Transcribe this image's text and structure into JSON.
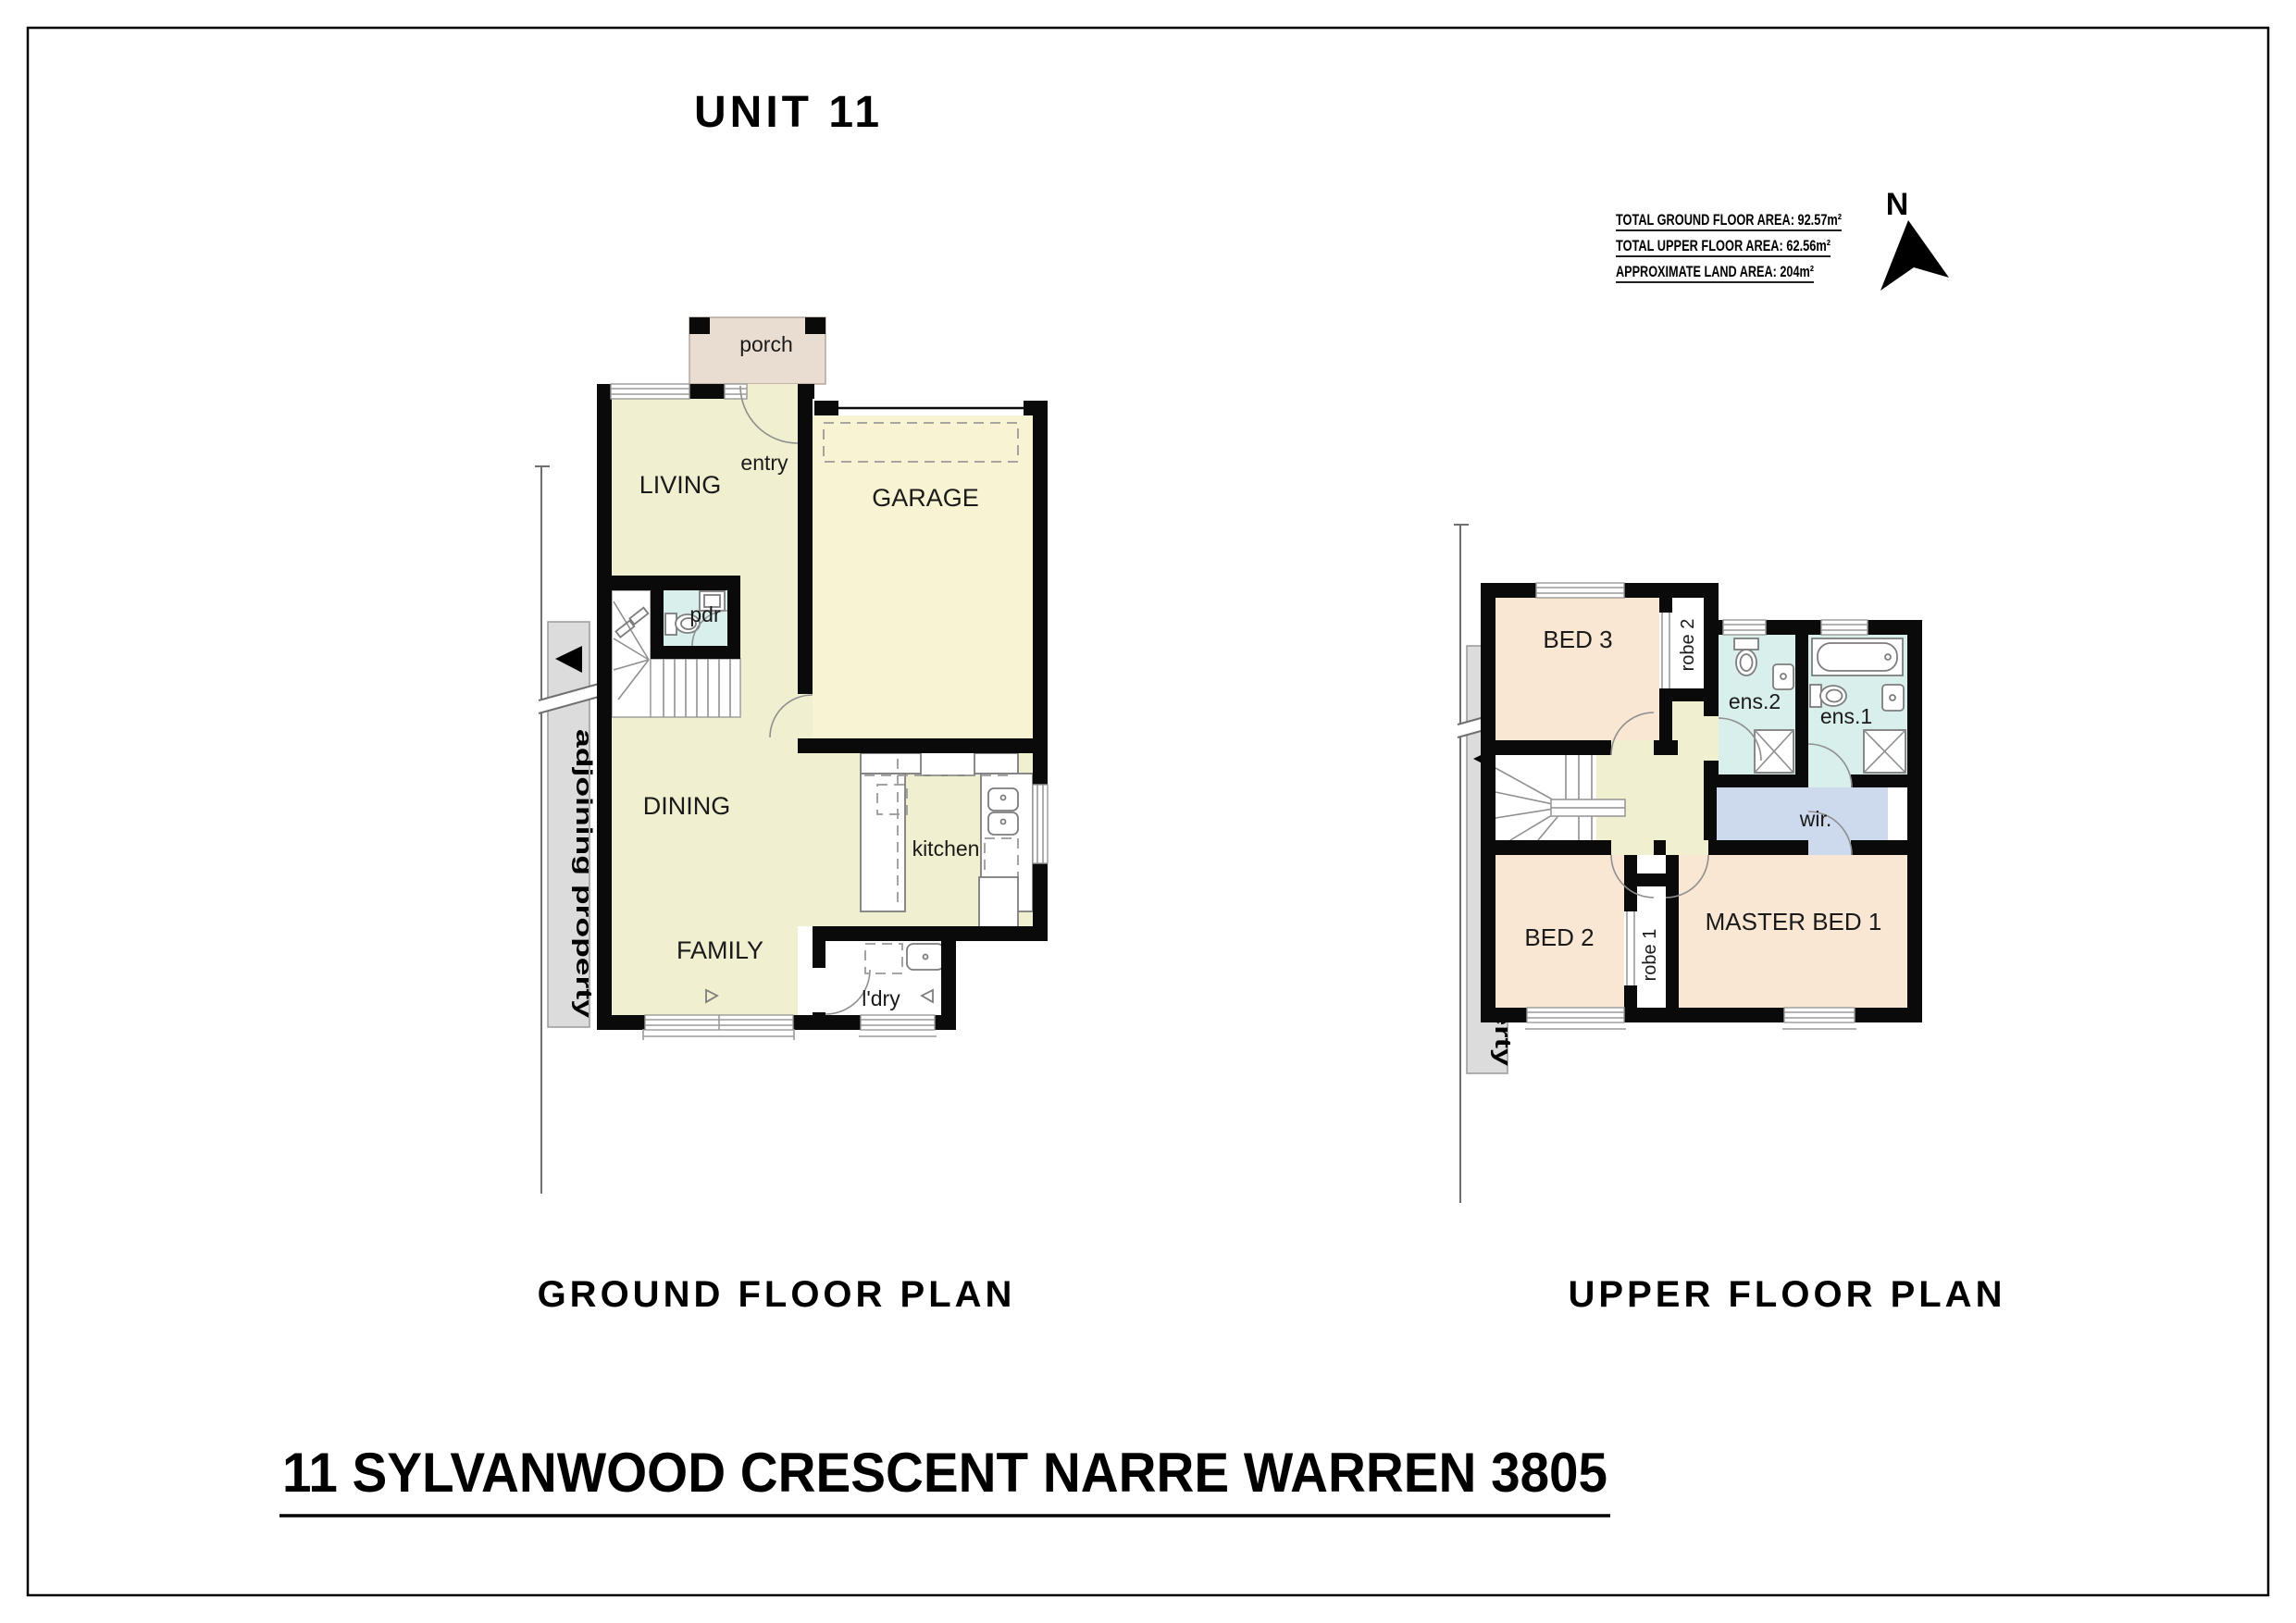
{
  "page": {
    "unit_title": "UNIT 11",
    "ground_plan_title": "GROUND FLOOR PLAN",
    "upper_plan_title": "UPPER FLOOR PLAN",
    "address": "11 SYLVANWOOD CRESCENT NARRE WARREN 3805"
  },
  "areas": {
    "ground": "TOTAL GROUND FLOOR AREA: 92.57m²",
    "upper": "TOTAL UPPER FLOOR AREA: 62.56m²",
    "land": "APPROXIMATE LAND AREA: 204m²"
  },
  "compass": {
    "north": "N"
  },
  "ground_floor": {
    "boundary_label": "adjoining property",
    "rooms": {
      "porch": "porch",
      "entry": "entry",
      "living": "LIVING",
      "garage": "GARAGE",
      "pdr": "pdr",
      "dining": "DINING",
      "kitchen": "kitchen",
      "family": "FAMILY",
      "laundry": "l'dry"
    }
  },
  "upper_floor": {
    "boundary_label": "adjoining property",
    "rooms": {
      "bed3": "BED 3",
      "robe2": "robe 2",
      "ens2": "ens.2",
      "ens1": "ens.1",
      "wir": "wir.",
      "bed2": "BED 2",
      "robe1": "robe 1",
      "master": "MASTER BED 1"
    }
  },
  "colors": {
    "wall": "#0a0a0a",
    "floor_main": "#f0efd0",
    "garage": "#f8f3d2",
    "porch": "#e9ddd2",
    "bathroom": "#d8efeb",
    "bedroom": "#f9e7d3",
    "wir": "#cdd9ec",
    "boundary_strip": "#dcdcdc"
  }
}
